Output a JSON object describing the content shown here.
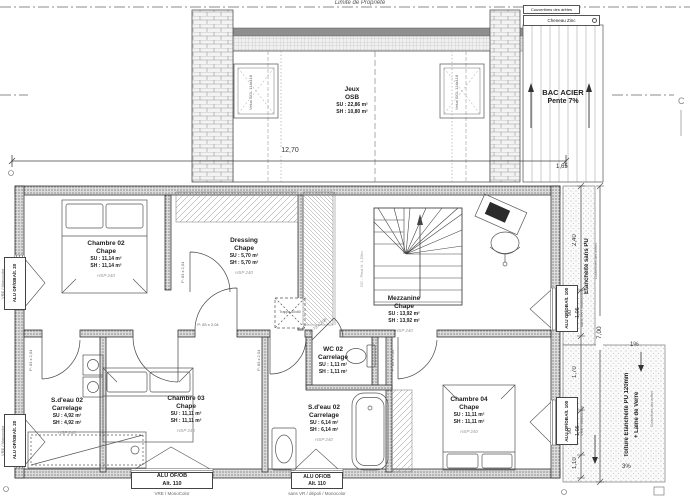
{
  "site": {
    "limite": "Limite de Propriété",
    "section_c": "C"
  },
  "roof_top": {
    "couvertines": "Couvertines des arêtes",
    "cheneau": "Cheneau Zinc",
    "bac_acier_1": "BAC ACIER",
    "bac_acier_2": "Pente 7%",
    "velux": "Velux GGL 114x118",
    "jeux": {
      "name": "Jeux",
      "floor": "OSB",
      "su": "SU : 22,86 m²",
      "sh": "SH : 10,80 m²"
    }
  },
  "rooms": {
    "chambre02": {
      "name": "Chambre 02",
      "floor": "Chape",
      "su": "SU : 11,14 m²",
      "sh": "SH : 11,14 m²",
      "hsp": "HSP 240"
    },
    "dressing": {
      "name": "Dressing",
      "floor": "Chape",
      "su": "SU : 5,70 m²",
      "sh": "SH : 5,70 m²",
      "hsp": "HSP 240"
    },
    "mezzanine": {
      "name": "Mezzanine",
      "floor": "Chape",
      "su": "SU : 13,92 m²",
      "sh": "SH : 13,92 m²",
      "hsp": "HSP 240"
    },
    "wc02": {
      "name": "WC 02",
      "floor": "Carrelage",
      "su": "SU : 1,11 m²",
      "sh": "SH : 1,11 m²"
    },
    "sdeau_gauche": {
      "name": "S.d'eau 02",
      "floor": "Carrelage",
      "su": "SU : 4,92 m²",
      "sh": "SH : 4,92 m²",
      "hsp": "HSP 240"
    },
    "chambre03": {
      "name": "Chambre 03",
      "floor": "Chape",
      "su": "SU : 11,11 m²",
      "sh": "SH : 11,11 m²",
      "hsp": "HSP 240"
    },
    "sdeau_milieu": {
      "name": "S.d'eau 02",
      "floor": "Carrelage",
      "su": "SU : 6,14 m²",
      "sh": "SH : 6,14 m²",
      "hsp": "HSP 240"
    },
    "chambre04": {
      "name": "Chambre 04",
      "floor": "Chape",
      "su": "SU : 11,11 m²",
      "sh": "SH : 11,11 m²",
      "hsp": "HSP 240"
    }
  },
  "windows": {
    "alt20": {
      "material": "ALU OF/OB",
      "alt": "Alt. 20"
    },
    "alt100": {
      "material": "ALU OF/OB",
      "alt": "Alt. 100"
    },
    "alt110": {
      "material": "ALU OF/OB",
      "alt": "Alt. 110"
    },
    "note_vre": "VRE / MonoColor",
    "note_vre_mono": "VRE / Monocolor",
    "note_sans_vr": "sans VR / dépoli / Monocolor",
    "note_sans_vr_mono": "sans VR / Monocolor"
  },
  "doors": {
    "p83": "P: 83 x 2,04",
    "p73": "P: 73 x 2,04"
  },
  "stairs": {
    "gc": "GC - Plexi H. 1,50m"
  },
  "trappe": "Trappe 60x60",
  "dimensions": {
    "total_width": "12,70",
    "d_165": "1,65",
    "d_240": "2,40",
    "d_90": "90",
    "d_105": "1,05",
    "d_170": "1,70",
    "d_110": "1,10",
    "total_height": "7,00"
  },
  "roof_right": {
    "etancheite": "Etanchéité sans PU",
    "toiture_l1": "Toiture Etanchéité PU 120mm",
    "toiture_l2": "+ Laine de Verre",
    "slope1": "1%",
    "slope3": "3%",
    "couvertines": "Couvertines des arêtes"
  }
}
